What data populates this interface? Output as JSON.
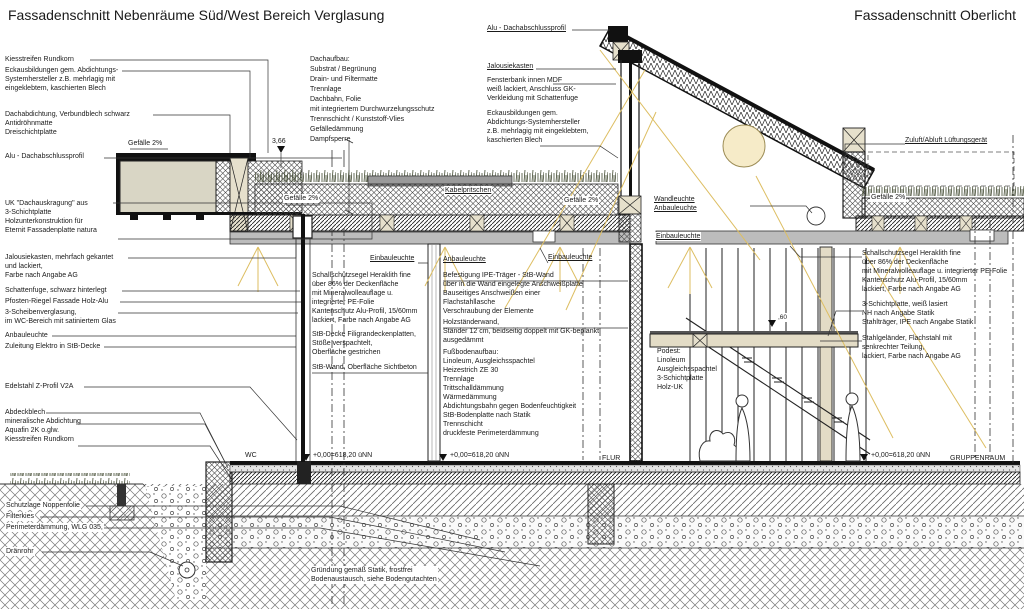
{
  "titles": {
    "left": "Fassadenschnitt Nebenräume Süd/West Bereich Verglasung",
    "right": "Fassadenschnitt Oberlicht"
  },
  "slopes": {
    "text": "Gefälle 2%"
  },
  "elevations": {
    "roof": "3,66",
    "floor": "+0,00=618,20 üNN",
    "podest": ",60"
  },
  "rooms": {
    "wc": "WC",
    "flur": "FLUR",
    "gruppenraum": "GRUPPENRAUM"
  },
  "labels": {
    "kiesstreifen_top": "Kiesstreifen Rundkorn",
    "eckausbildungen_left": "Eckausbildungen gem. Abdichtungs-\nSystemhersteller z.B. mehrlagig mit\neingeklebtem, kaschierten Blech",
    "dachabdichtung": "Dachabdichtung, Verbundblech schwarz\nAntidröhnmatte\nDreischichtplatte",
    "alu_profil_left": "Alu - Dachabschlussprofil",
    "uk_dachauskragung": "UK \"Dachauskragung\" aus\n3-Schichtplatte\nHolzunterkonstruktion für\nEternit Fassadenplatte natura",
    "jalousiekasten_left": "Jalousiekasten, mehrfach gekantet\nund lackiert,\nFarbe nach Angabe AG",
    "schattenfuge": "Schattenfuge, schwarz hinterlegt",
    "pfosten_riegel": "Pfosten-Riegel Fassade Holz-Alu",
    "verglasung": "3-Scheibenverglasung,\nim WC-Bereich mit satiniertem Glas",
    "anbauleuchte_left": "Anbauleuchte",
    "zuleitung": "Zuleitung Elektro in StB-Decke",
    "edelstahl": "Edelstahl Z-Profil V2A",
    "abdeckblech": "Abdeckblech\nmineralische Abdichtung\nAquafin 2K o.glw.\nKiesstreifen Rundkorn",
    "noppenfolie": "Schutzlage Noppenfolie",
    "filterkies": "Filterkies",
    "perimeterdaemmung": "Perimeterdämmung, WLG 035,",
    "draenrohr": "Dränrohr",
    "dachaufbau": "Dachaufbau:\nSubstrat / Begrünung\nDrain- und Filtermatte\nTrennlage\nDachbahn, Folie\nmit integriertem Durchwurzelungsschutz\nTrennschicht / Kunststoff-Vlies\nGefälledämmung\nDampfsperre",
    "kabelpritschen": "Kabelpritschen",
    "einbauleuchte_1": "Einbauleuchte",
    "schallschutz_mid": "Schallschutzsegel Heraklith fine\nüber 86% der Deckenfläche\nmit Mineralwolleauflage u.\nintegrierter PE-Folie\nKantenschutz Alu-Profil, 15/60mm\nlackiert, Farbe nach Angabe AG",
    "stb_decke": "StB-Decke Filigrandeckenplatten,\nStöße verspachtelt,\nOberfläche gestrichen",
    "stb_wand": "StB-Wand, Oberfläche Sichtbeton",
    "anbauleuchte_mid": "Anbauleuchte",
    "einbauleuchte_2": "Einbauleuchte",
    "befestigung": "Befestigung IPE-Träger - StB-Wand\nüber in die Wand eingelegte Anschweißplatte\nBauseitiges Anschweißen einer\nFlachstahllasche\nVerschraubung der Elemente",
    "holzstaenderwand": "Holzständerwand,\nStänder 12 cm, beidseitig doppelt mit GK-beplankt\nausgedämmt",
    "fussbodenaufbau": "Fußbodenaufbau:\nLinoleum, Ausgleichsspachtel\nHeizestrich ZE 30\nTrennlage\nTrittschalldämmung\nWärmedämmung\nAbdichtungsbahn gegen Bodenfeuchtigkeit\nStB-Bodenplatte nach Statik\nTrennschicht\ndruckfeste Perimeterdämmung",
    "alu_profil_right": "Alu - Dachabschlussprofil",
    "jalousiekasten_right": "Jalousiekasten",
    "fensterbank": "Fensterbank innen MDF\nweiß lackiert, Anschluss GK-\nVerkleidung mit Schattenfuge",
    "eckausbildungen_right": "Eckausbildungen gem.\nAbdichtungs-Systemhersteller\nz.B. mehrlagig mit eingeklebtem,\nkaschierten Blech",
    "zuluft": "Zuluft/Abluft Lüftungsgerät",
    "wandleuchte": "Wandleuchte\nAnbauleuchte",
    "einbauleuchte_3": "Einbauleuchte",
    "schallschutz_right": "Schallschutzsegel Heraklith fine\nüber 86% der Deckenfläche\nmit Mineralwolleauflage u. integrierter PE-Folie\nKantenschutz Alu-Profil, 15/60mm\nlackiert, Farbe nach Angabe AG",
    "schichtplatte_right": "3-Schichtplatte, weiß lasiert\nNH nach Angabe Statik\nStahlträger, IPE nach Angabe Statik",
    "gelaender": "Stahlgeländer, Flachstahl mit\nsenkrechter Teilung,\nlackiert, Farbe nach Angabe AG",
    "podest": "Podest:\nLinoleum\nAusgleichsspachtel\n3-Schichtplatte\nHolz-UK",
    "gruendung": "Gründung gemäß Statik, frostfrei\nBodenaustausch, siehe Bodengutachten"
  },
  "colors": {
    "line": "#1a1a1a",
    "panel_beige": "#d9d6c5",
    "ceiling_grey": "#bcbcbc",
    "sun_fill": "#f6ebc8",
    "light_ray": "#ddbe62"
  }
}
